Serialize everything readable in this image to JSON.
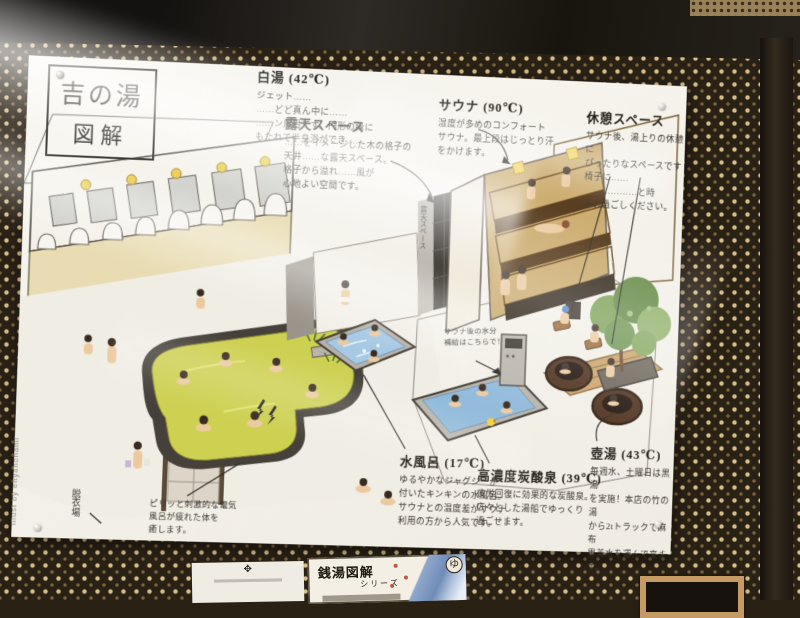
{
  "poster": {
    "title_line1": "吉の湯",
    "title_line2": "図解",
    "credit": "illust by enyahonami",
    "sections": [
      {
        "id": "shirayu",
        "heading": "白湯 (42℃)",
        "body": "ジェット……\n……どど真ん中に……\n……ン風呂です。円形の縁に\nもたれて半身浴ができ……"
      },
      {
        "id": "roten",
        "heading": "露天スペース",
        "body": "……をイメージした木の格子の\n天井……な露天スペース。\n格子から溢れ……風が\n心地よい空間です。"
      },
      {
        "id": "sauna",
        "heading": "サウナ (90℃)",
        "body": "湿度が多めのコンフォート\nサウナ。最上段はじっとり汗\nをかけます。"
      },
      {
        "id": "kyukei",
        "heading": "休憩スペース",
        "body": "サウナ後、湯上りの休憩に\nぴったりなスペースです\n椅子に……\n　……………と時\nをお過ごしください。"
      },
      {
        "id": "mizuburo",
        "heading": "水風呂 (17℃)",
        "body": "ゆるやかなジャグジーが\n付いたキンキンの水風呂。\nサウナとの温度差がサウナ\n利用の方から人気です。"
      },
      {
        "id": "tansan",
        "heading": "高濃度炭酸泉 (39℃)",
        "body": "疲労回復に効果的な炭酸泉。\n広々とした湯船でゆっくり\n過ごせます。"
      },
      {
        "id": "tsuboyu",
        "heading": "壺湯 (43℃)",
        "body": "毎週水、土曜日は黒湯\nを実施！本店の竹の湯\nから2tトラックで麻布\n黒美水を運んで来ます。"
      }
    ],
    "notes": {
      "denki": "ピリッと刺激的な電気\n風呂が疲れた体を\n癒します。",
      "water_refill": "サウナ後の水分\n補給はこちらで！",
      "datsuiba": "脱衣場",
      "roten_wall_label": "露天スペース"
    }
  },
  "bottom_items": {
    "series_card": {
      "title": "銭湯図解",
      "subtitle": "シリーズ",
      "stamp": "ゆ"
    },
    "crest_glyph": "✥"
  },
  "colors": {
    "poster_paper": "#f6f3ec",
    "wallpaper_base": "#2a2115",
    "wallpaper_diamond": "#d9c08c",
    "bath_yellow": "#cdd051",
    "water_blue": "#a7c9e4",
    "sauna_mat": "#d99f3f",
    "counter_orange": "#c06038",
    "tree_green": "#7ca055"
  }
}
